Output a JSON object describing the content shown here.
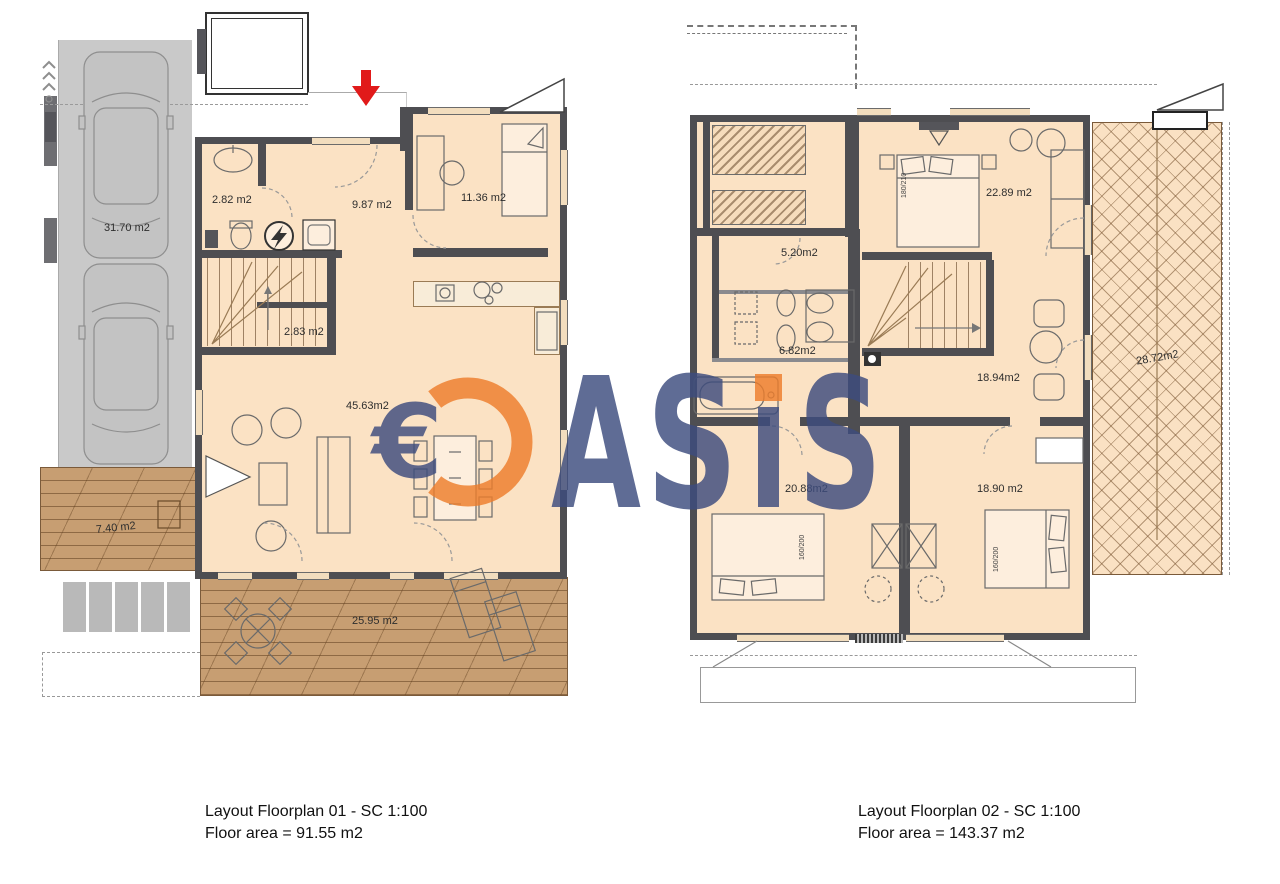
{
  "plan1": {
    "caption_line1": "Layout Floorplan 01 - SC 1:100",
    "caption_line2": "Floor area = 91.55 m2",
    "rooms": {
      "wc": "2.82 m2",
      "hallway": "9.87 m2",
      "bedroom": "11.36 m2",
      "stairs": "2.83 m2",
      "living_room": "45.63m2",
      "driveway": "31.70 m2",
      "side_deck": "7.40 m2",
      "terrace": "25.95 m2"
    }
  },
  "plan2": {
    "caption_line1": "Layout Floorplan 02 - SC 1:100",
    "caption_line2": "Floor area = 143.37 m2",
    "rooms": {
      "bedroom_master": "22.89 m2",
      "corridor": "5.20m2",
      "bathroom": "6.82m2",
      "landing": "18.94m2",
      "bedroom_left": "20.88m2",
      "bedroom_right": "18.90 m2",
      "balcony": "28.72m2"
    },
    "bed_sizes": {
      "master": "180/210",
      "left": "160/200",
      "right": "160/200"
    }
  },
  "watermark": {
    "euro_symbol": "€",
    "letters": [
      "A",
      "S",
      "S"
    ],
    "navy_color": "#3d4c7e",
    "orange_color": "#ee7e2c"
  },
  "icons": {
    "electrical_panel": "lightning-icon",
    "entrance_marker": "red-arrow-down-icon"
  }
}
